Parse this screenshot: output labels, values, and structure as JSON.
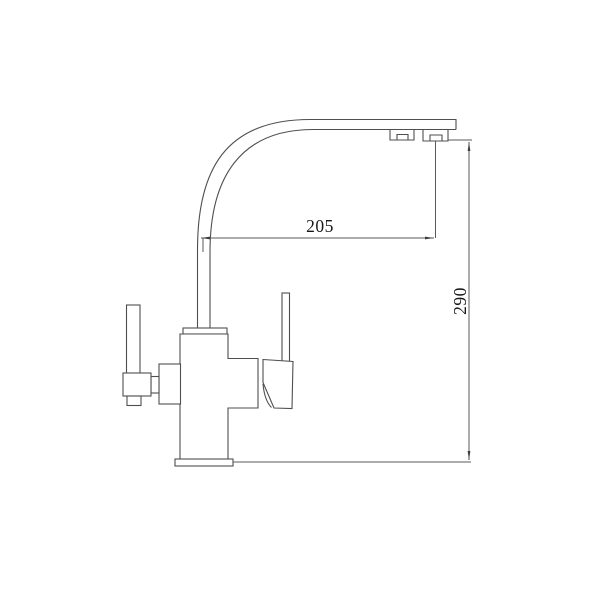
{
  "drawing": {
    "kind": "technical-line-drawing",
    "subject": "kitchen-faucet-side-view",
    "background_color": "#ffffff",
    "line_color": "#4f4f4f",
    "dimension_text_color": "#181818",
    "dimensions": {
      "horizontal": {
        "label": "205"
      },
      "vertical": {
        "label": "290"
      }
    }
  }
}
